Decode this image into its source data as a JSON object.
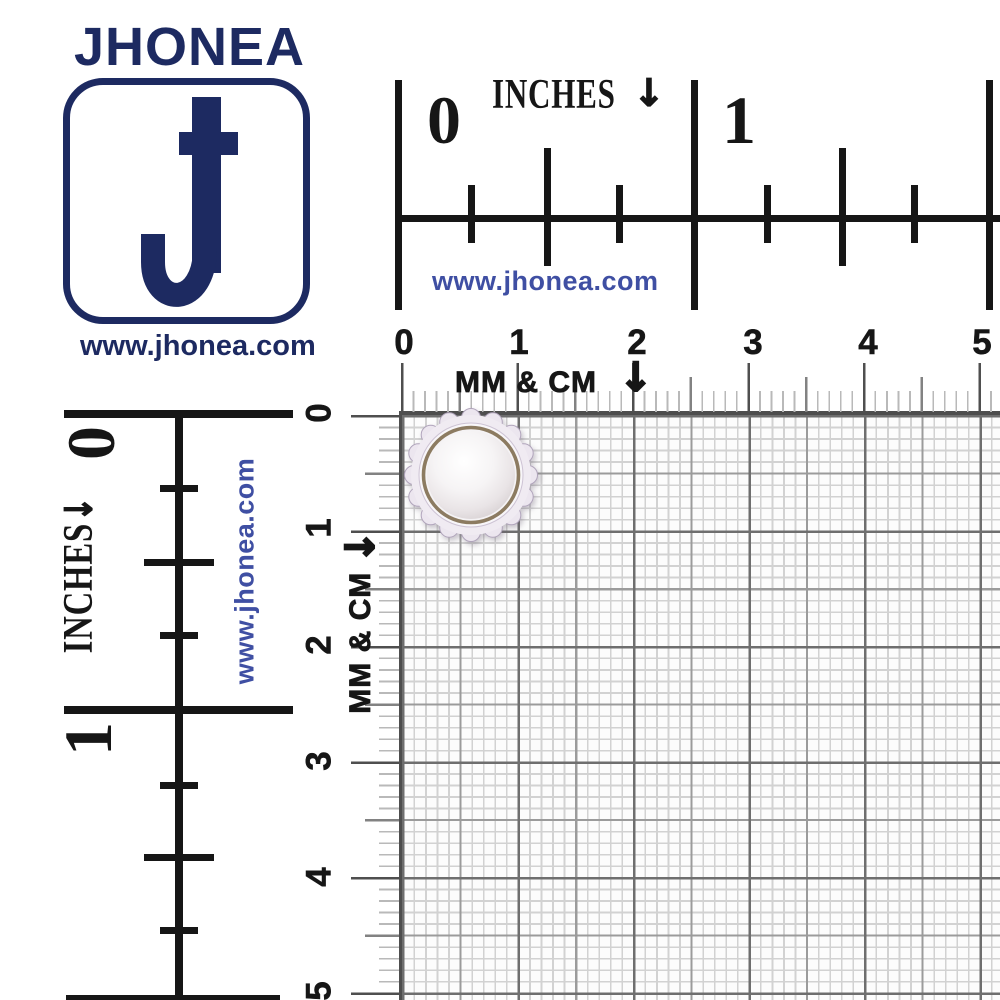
{
  "brand": {
    "name": "JHONEA",
    "website": "www.jhonea.com",
    "logo_letter": "J"
  },
  "colors": {
    "navy": "#1d2a61",
    "link_blue": "#3f4fa3",
    "ruler_black": "#161616",
    "grid_fine_line": "#d2d2d2",
    "grid_half_cm_line": "#9b9b9b",
    "grid_cm_line": "#6e6e6e",
    "pearl_gold_ring": "#8c7b61",
    "pearl_rim": "#ece6ef",
    "pearl_white": "#f7f5f6"
  },
  "top_inch_ruler": {
    "unit_label": "INCHES",
    "arrow": "↓",
    "numbers": [
      "0",
      "1"
    ],
    "website": "www.jhonea.com"
  },
  "left_inch_ruler": {
    "unit_label": "INCHES",
    "arrow": "↓",
    "numbers": [
      "0",
      "1"
    ],
    "website": "www.jhonea.com"
  },
  "top_metric_ruler": {
    "unit_label": "MM & CM",
    "arrow": "↓",
    "numbers": [
      "0",
      "1",
      "2",
      "3",
      "4",
      "5"
    ]
  },
  "left_metric_ruler": {
    "unit_label": "MM & CM",
    "arrow": "↓",
    "numbers": [
      "0",
      "1",
      "2",
      "3",
      "4",
      "5"
    ]
  },
  "product": {
    "name": "white pearl button with scalloped silver rim",
    "approx_diameter_cm": 1.2,
    "position_on_grid_cm": {
      "x": 0.55,
      "y": 0.5
    }
  }
}
